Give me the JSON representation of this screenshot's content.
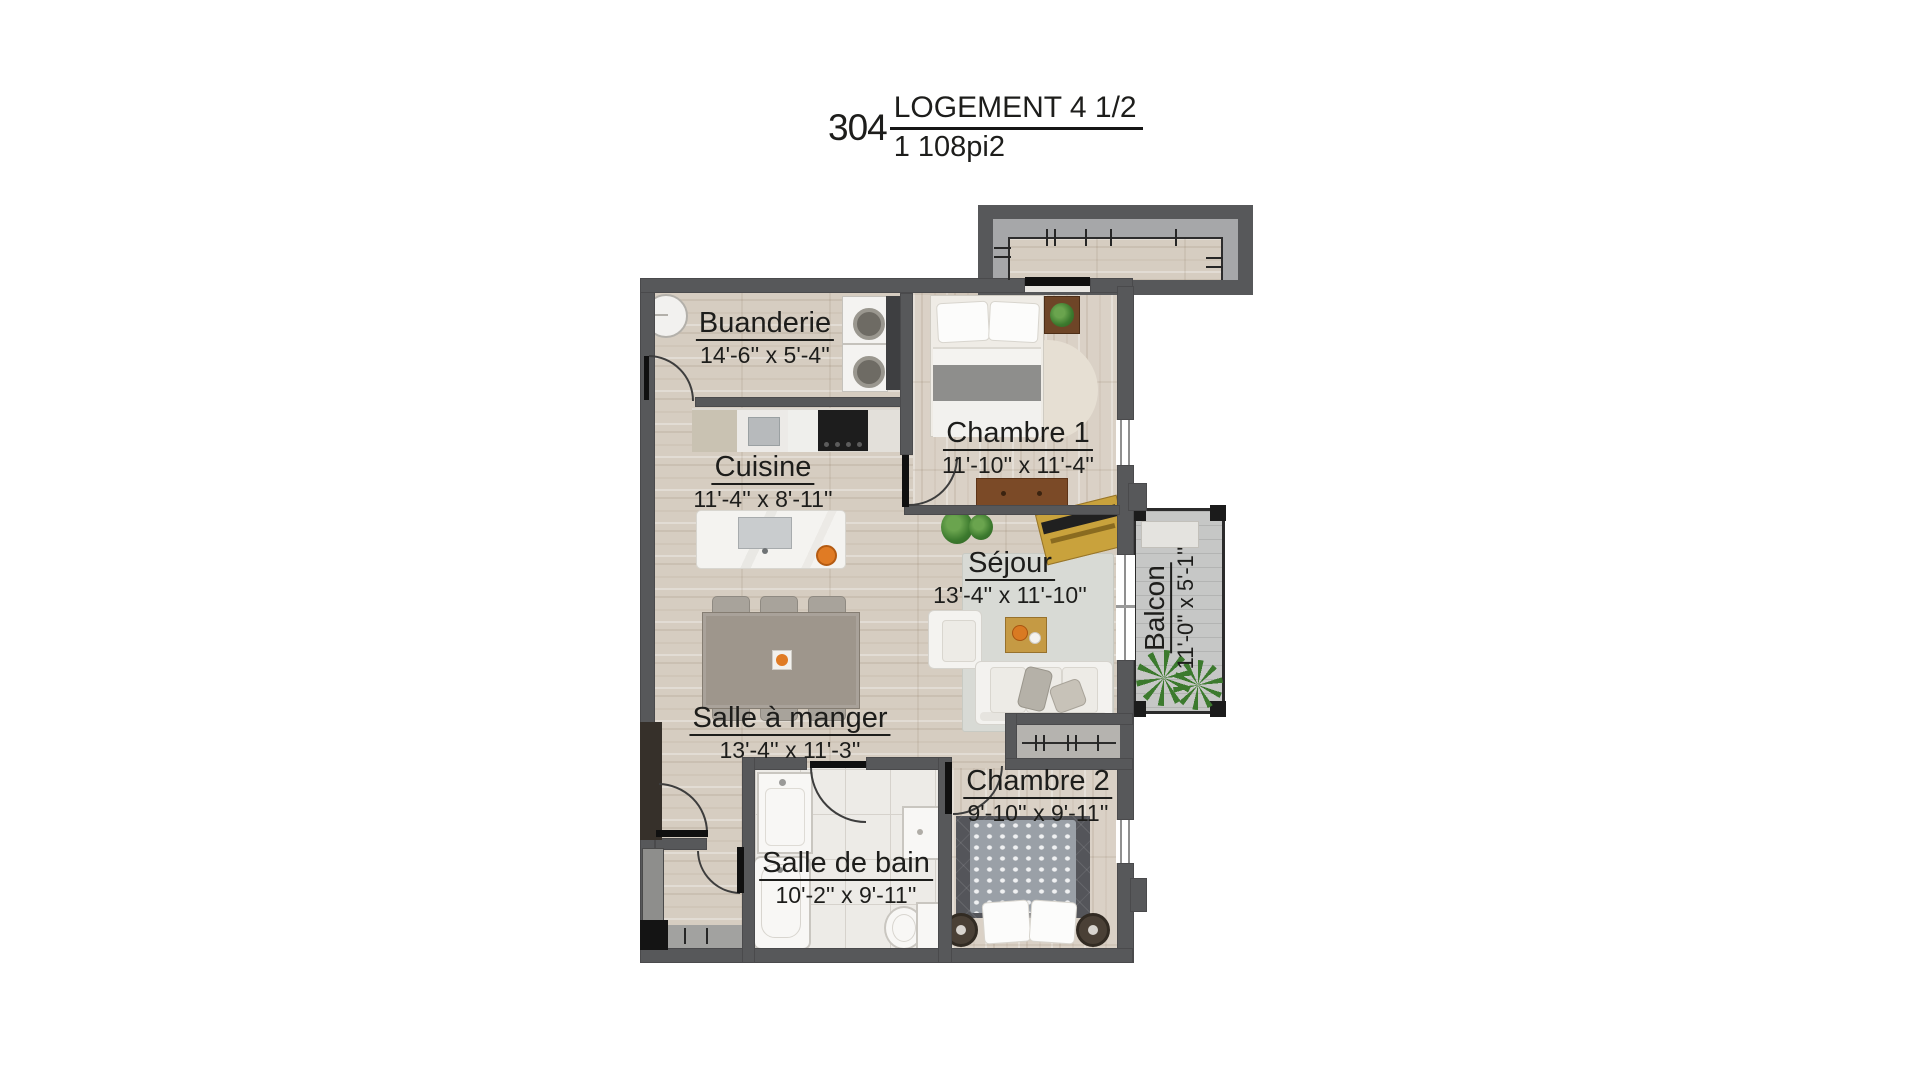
{
  "title": {
    "unit_number": "304",
    "name": "LOGEMENT 4 1/2",
    "area": "1 108pi2"
  },
  "rooms": [
    {
      "id": "buanderie",
      "label": "Buanderie",
      "dimensions": "14'-6'' x 5'-4''"
    },
    {
      "id": "chambre-1",
      "label": "Chambre 1",
      "dimensions": "11'-10'' x 11'-4''"
    },
    {
      "id": "cuisine",
      "label": "Cuisine",
      "dimensions": "11'-4'' x 8'-11''"
    },
    {
      "id": "sejour",
      "label": "Séjour",
      "dimensions": "13'-4'' x 11'-10''"
    },
    {
      "id": "balcon",
      "label": "Balcon",
      "dimensions": "11'-0'' x 5'-1''"
    },
    {
      "id": "salle-a-manger",
      "label": "Salle à manger",
      "dimensions": "13'-4'' x 11'-3''"
    },
    {
      "id": "salle-de-bain",
      "label": "Salle de bain",
      "dimensions": "10'-2'' x 9'-11''"
    },
    {
      "id": "chambre-2",
      "label": "Chambre 2",
      "dimensions": "9'-10'' x 9'-11''"
    }
  ],
  "colors": {
    "wall": "#57585a",
    "wood_floor": "#d6cdc1",
    "tile_floor": "#edebe7",
    "balcony_deck": "#c6c7c6",
    "corridor_concrete": "#a6a7a9",
    "text": "#1d1d1b",
    "wood_furniture": "#7b4a27",
    "accent_orange": "#e07b24",
    "plant_green": "#3c7a2e"
  }
}
